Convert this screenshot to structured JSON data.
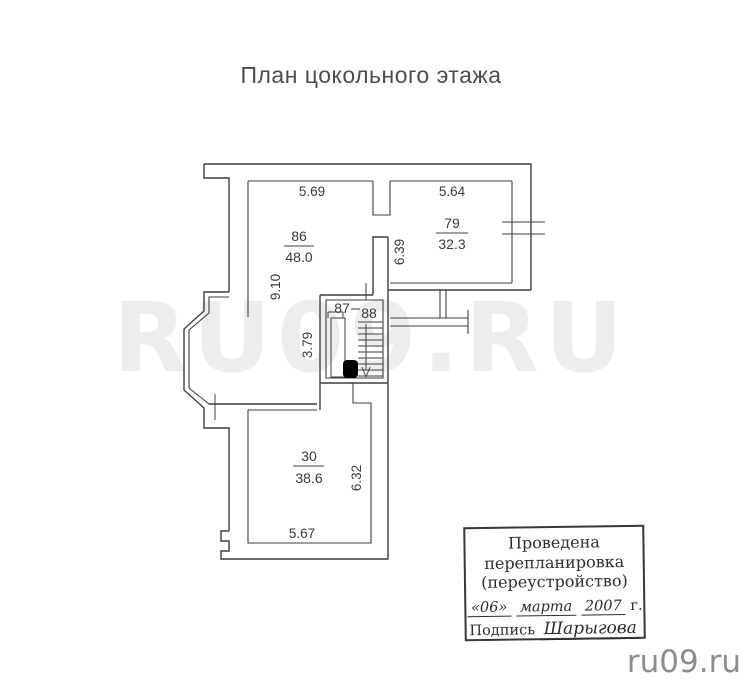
{
  "title": "План цокольного этажа",
  "watermarks": {
    "large": "RU09.RU",
    "corner": "ru09.ru"
  },
  "colors": {
    "ink": "#3f3f3f",
    "watermark_large": "#ededed",
    "watermark_corner": "#8d8d8d"
  },
  "plan": {
    "rooms": {
      "r86": {
        "number": "86",
        "area": "48.0"
      },
      "r79": {
        "number": "79",
        "area": "32.3"
      },
      "r87": {
        "number": "87"
      },
      "r88": {
        "number": "88"
      },
      "r30": {
        "number": "30",
        "area": "38.6"
      }
    },
    "dimensions": {
      "top_left": "5.69",
      "top_right": "5.64",
      "left": "9.10",
      "middle": "6.39",
      "stair": "3.79",
      "lower_right": "6.32",
      "bottom": "5.67"
    }
  },
  "stamp": {
    "line1": "Проведена",
    "line2": "перепланировка",
    "line3": "(переустройство)",
    "date_day": "«06»",
    "date_month": "марта",
    "date_year": "2007",
    "date_suffix": "г.",
    "signature_label": "Подпись",
    "signature": "Шарыгова"
  }
}
